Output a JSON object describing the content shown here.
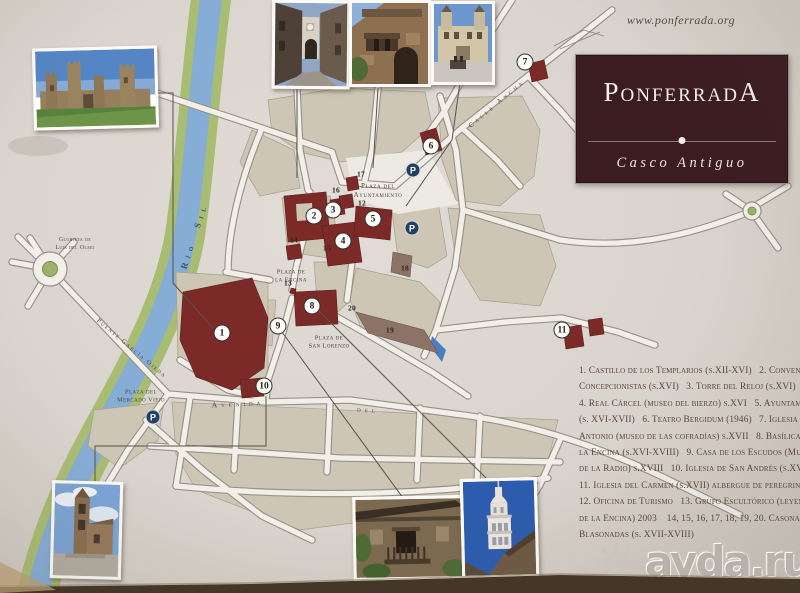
{
  "header": {
    "website": "www.ponferrada.org"
  },
  "title_box": {
    "title": "PonferradA",
    "subtitle": "Casco Antiguo"
  },
  "watermark": {
    "label": "ayda.ru",
    "icon": "spiral-sun"
  },
  "colors": {
    "board": "#d9d4cd",
    "building_accent": "#7c2a27",
    "title_box": "#3b1c21",
    "river": "#86add5",
    "river_bank": "#a9bd72",
    "city_block": "#cdc6b4",
    "parking_badge": "#223f68",
    "legend_text": "#5c443b"
  },
  "map": {
    "parking_label": "P",
    "area_labels": [
      {
        "id": "glorieta-luis-del-olmo",
        "text": "Glorieta de\nLuis del Olmo",
        "x": 75,
        "y": 245,
        "rot": 0,
        "size": 6,
        "spacing": 0.4
      },
      {
        "id": "rio-sil",
        "text": "Río  Sil",
        "x": 195,
        "y": 236,
        "rot": -72,
        "size": 9,
        "spacing": 5,
        "cls": "river"
      },
      {
        "id": "puente-garcia-ojeda",
        "text": "Puente García Ojeda",
        "x": 131,
        "y": 349,
        "rot": 40,
        "size": 6.5,
        "spacing": 1.5
      },
      {
        "id": "plaza-del-ayuntamiento",
        "text": "Plaza del\nAyuntamiento",
        "x": 378,
        "y": 191,
        "rot": 0,
        "size": 7,
        "spacing": 0.6
      },
      {
        "id": "plaza-de-la-encina",
        "text": "Plaza de\nla Encina",
        "x": 291,
        "y": 277,
        "rot": 0,
        "size": 6.5,
        "spacing": 0.4
      },
      {
        "id": "plaza-de-san-lorenzo",
        "text": "Plaza de\nSan Lorenzo",
        "x": 329,
        "y": 343,
        "rot": 0,
        "size": 6.5,
        "spacing": 0.4
      },
      {
        "id": "plaza-del-mercado-viejo",
        "text": "Plaza del\nMercado Viejo",
        "x": 141,
        "y": 397,
        "rot": 0,
        "size": 6.5,
        "spacing": 0.4
      },
      {
        "id": "calle-ancha",
        "text": "Calle Ancha",
        "x": 497,
        "y": 104,
        "rot": -40,
        "size": 7,
        "spacing": 3
      },
      {
        "id": "avenida",
        "text": "Avenida",
        "x": 238,
        "y": 404,
        "rot": -3,
        "size": 7.5,
        "spacing": 4
      },
      {
        "id": "avenida-del",
        "text": "del",
        "x": 368,
        "y": 410,
        "rot": 3,
        "size": 7.5,
        "spacing": 4
      }
    ],
    "markers": [
      {
        "n": "1",
        "x": 222,
        "y": 333
      },
      {
        "n": "2",
        "x": 314,
        "y": 216
      },
      {
        "n": "3",
        "x": 333,
        "y": 210
      },
      {
        "n": "4",
        "x": 343,
        "y": 241
      },
      {
        "n": "5",
        "x": 373,
        "y": 219
      },
      {
        "n": "6",
        "x": 431,
        "y": 146
      },
      {
        "n": "7",
        "x": 525,
        "y": 62
      },
      {
        "n": "8",
        "x": 312,
        "y": 306
      },
      {
        "n": "9",
        "x": 278,
        "y": 326
      },
      {
        "n": "10",
        "x": 264,
        "y": 386
      },
      {
        "n": "11",
        "x": 562,
        "y": 330
      }
    ],
    "parking_spots": [
      {
        "x": 413,
        "y": 170
      },
      {
        "x": 412,
        "y": 228
      },
      {
        "x": 153,
        "y": 417
      }
    ],
    "small_numbers": [
      {
        "n": "12",
        "x": 362,
        "y": 203
      },
      {
        "n": "13",
        "x": 288,
        "y": 283
      },
      {
        "n": "14",
        "x": 294,
        "y": 240
      },
      {
        "n": "15",
        "x": 327,
        "y": 248
      },
      {
        "n": "16",
        "x": 336,
        "y": 190
      },
      {
        "n": "17",
        "x": 361,
        "y": 174
      },
      {
        "n": "18",
        "x": 405,
        "y": 268
      },
      {
        "n": "19",
        "x": 390,
        "y": 330
      },
      {
        "n": "20",
        "x": 352,
        "y": 308
      }
    ]
  },
  "legend": {
    "lines": [
      "1. Castillo de los Templarios (s.XII-XVI)   2. Convento",
      "Concepcionistas (s.XVI)   3. Torre del Reloj (s.XVI)",
      "4. Real Cárcel (museo del bierzo) s.XVI   5. Ayuntamiento",
      "(s. XVI-XVII)   6. Teatro Bergidum (1946)   7. Iglesia de San",
      "Antonio (museo de las cofradías) s.XVII   8. Basílica de",
      "la Encina (s.XVI-XVIII)   9. Casa de los Escudos (Museo",
      "de la Radio) s.XVIII   10. Iglesia de San Andrés (s.XVII)",
      "11. Iglesia del Carmen (s.XVII) albergue de peregrinos",
      "12. Oficina de Turismo   13. Grupo Escultórico (leyenda",
      "de la Encina) 2003    14, 15, 16, 17, 18, 19, 20. Casonas",
      "Blasonadas (s. XVII-XVIII)"
    ]
  }
}
